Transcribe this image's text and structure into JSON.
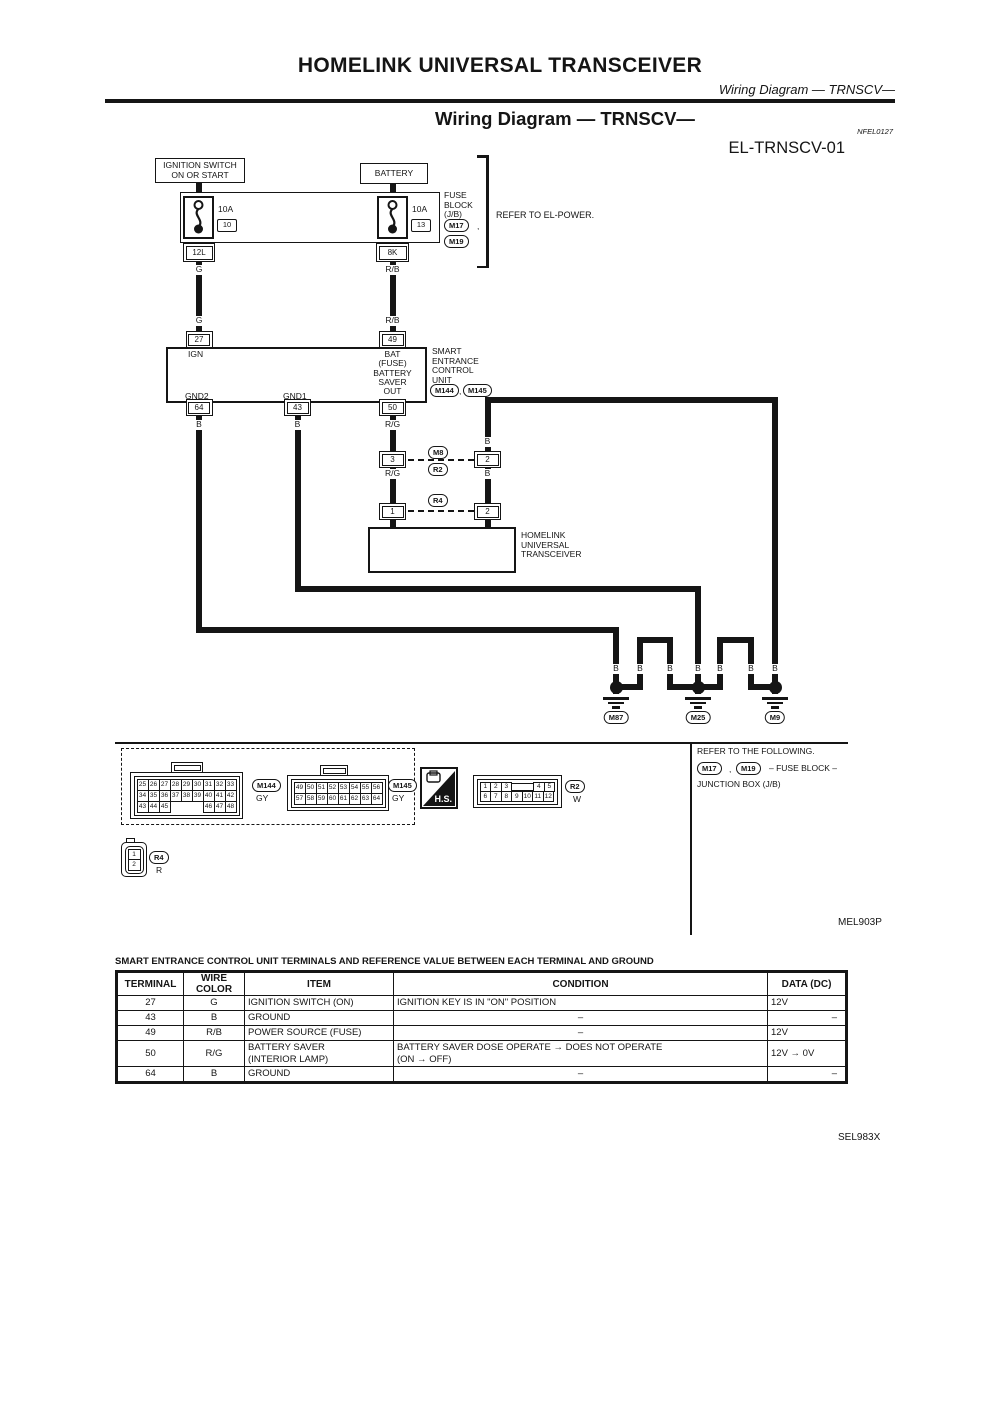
{
  "page": {
    "title": "HOMELINK UNIVERSAL TRANSCEIVER",
    "subtitle": "Wiring Diagram — TRNSCV—",
    "section_title": "Wiring Diagram — TRNSCV—",
    "ref_code": "NFEL0127",
    "sheet_id": "EL-TRNSCV-01",
    "figure_code": "MEL903P",
    "sheet_code": "SEL983X"
  },
  "misc": {
    "comma": ","
  },
  "diagram": {
    "ignition_box": {
      "line1": "IGNITION SWITCH",
      "line2": "ON OR START"
    },
    "battery_box": {
      "label": "BATTERY"
    },
    "fuse_block": {
      "label_lines": [
        "FUSE",
        "BLOCK",
        "(J/B)"
      ],
      "connector_a": "M17",
      "connector_b": "M19",
      "note": "REFER TO EL-POWER.",
      "fuse1": {
        "rating": "10A",
        "number": "10",
        "out_terminal": "12L",
        "wire": "G"
      },
      "fuse2": {
        "rating": "10A",
        "number": "13",
        "out_terminal": "8K",
        "wire": "R/B"
      }
    },
    "secu": {
      "name_lines": [
        "SMART",
        "ENTRANCE",
        "CONTROL",
        "UNIT"
      ],
      "connector_a": "M144",
      "connector_b": "M145",
      "t27": {
        "num": "27",
        "label": "IGN",
        "wire": "G"
      },
      "t49": {
        "num": "49",
        "label1": "BAT",
        "label2": "(FUSE)",
        "wire": "R/B"
      },
      "t50": {
        "num": "50",
        "label1": "BATTERY",
        "label2": "SAVER",
        "label3": "OUT",
        "wire": "R/G"
      },
      "t43": {
        "num": "43",
        "label": "GND1",
        "wire": "B"
      },
      "t64": {
        "num": "64",
        "label": "GND2",
        "wire": "B"
      }
    },
    "inline_connector": {
      "m8": "M8",
      "r2": "R2",
      "pin_left": "3",
      "pin_right": "2",
      "wire_left": "R/G",
      "wire_right": "B",
      "wire_right_top": "B"
    },
    "r4_connector": {
      "id": "R4",
      "pin_left": "1",
      "pin_right": "2"
    },
    "transceiver": {
      "name_lines": [
        "HOMELINK",
        "UNIVERSAL",
        "TRANSCEIVER"
      ]
    },
    "grounds": {
      "wire_label": "B",
      "g1": "M87",
      "g2": "M25",
      "g3": "M9"
    }
  },
  "connector_detail": {
    "m144": {
      "id": "M144",
      "color": "GY",
      "rows": [
        [
          "25",
          "26",
          "27",
          "28",
          "29",
          "30",
          "31",
          "32",
          "33"
        ],
        [
          "34",
          "35",
          "36",
          "37",
          "38",
          "39",
          "40",
          "41",
          "42"
        ],
        [
          "43",
          "44",
          "45",
          "GAP",
          "GAP",
          "GAP",
          "46",
          "47",
          "48"
        ]
      ]
    },
    "m145": {
      "id": "M145",
      "color": "GY",
      "rows": [
        [
          "49",
          "50",
          "51",
          "52",
          "53",
          "54",
          "55",
          "56"
        ],
        [
          "57",
          "58",
          "59",
          "60",
          "61",
          "62",
          "63",
          "64"
        ]
      ]
    },
    "r2": {
      "id": "R2",
      "color": "W",
      "rows": [
        [
          "1",
          "2",
          "3",
          "KEY",
          "4",
          "5"
        ],
        [
          "6",
          "7",
          "8",
          "9",
          "10",
          "11",
          "12"
        ]
      ]
    },
    "r4": {
      "id": "R4",
      "color": "R",
      "rows": [
        [
          "1"
        ],
        [
          "2"
        ]
      ]
    },
    "hs": "H.S.",
    "notes": {
      "line1": "REFER TO THE FOLLOWING.",
      "m17": "M17",
      "m19": "M19",
      "line2_rest": "– FUSE BLOCK –",
      "line3": "JUNCTION BOX (J/B)"
    }
  },
  "table": {
    "title": "SMART ENTRANCE CONTROL UNIT TERMINALS AND REFERENCE VALUE BETWEEN EACH TERMINAL AND GROUND",
    "headers": [
      "TERMINAL",
      "WIRE COLOR",
      "ITEM",
      "CONDITION",
      "DATA (DC)"
    ],
    "rows": [
      {
        "terminal": "27",
        "wire_color": "G",
        "item": [
          "IGNITION SWITCH (ON)"
        ],
        "condition": [
          "IGNITION KEY IS IN \"ON\" POSITION"
        ],
        "cond_align": "left",
        "data": "12V",
        "data_align": "left"
      },
      {
        "terminal": "43",
        "wire_color": "B",
        "item": [
          "GROUND"
        ],
        "condition": [
          "–"
        ],
        "cond_align": "center",
        "data": "–",
        "data_align": "right"
      },
      {
        "terminal": "49",
        "wire_color": "R/B",
        "item": [
          "POWER SOURCE (FUSE)"
        ],
        "condition": [
          "–"
        ],
        "cond_align": "center",
        "data": "12V",
        "data_align": "left"
      },
      {
        "terminal": "50",
        "wire_color": "R/G",
        "item": [
          "BATTERY SAVER",
          "(INTERIOR LAMP)"
        ],
        "condition": [
          "BATTERY SAVER DOSE OPERATE → DOES NOT OPERATE",
          "(ON → OFF)"
        ],
        "cond_align": "left",
        "data": "12V → 0V",
        "data_align": "left"
      },
      {
        "terminal": "64",
        "wire_color": "B",
        "item": [
          "GROUND"
        ],
        "condition": [
          "–"
        ],
        "cond_align": "center",
        "data": "–",
        "data_align": "right"
      }
    ]
  }
}
